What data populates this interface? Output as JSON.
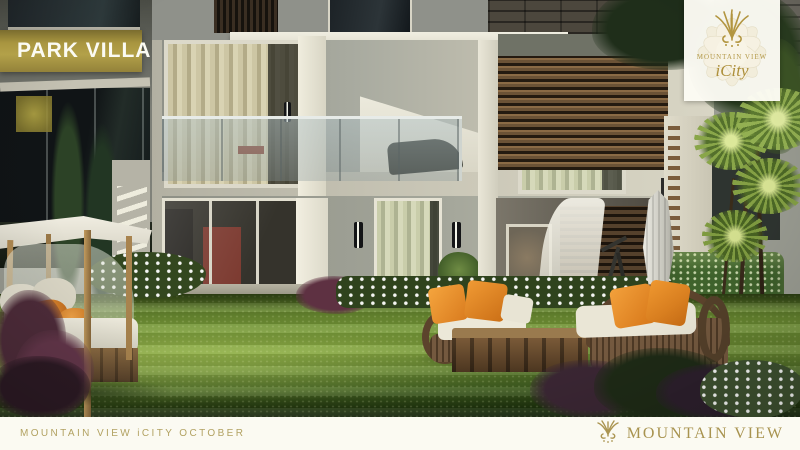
{
  "badge": {
    "label": "PARK VILLA"
  },
  "logo_card": {
    "brand": "MOUNTAIN VIEW",
    "sub_brand": "iCity",
    "icon": "lotus-flower-icon"
  },
  "footer": {
    "project_label": "MOUNTAIN VIEW iCITY OCTOBER",
    "brand": "MOUNTAIN VIEW",
    "icon": "palm-crest-icon"
  },
  "colors": {
    "badge_gold": "#b3a149",
    "logo_gold": "#b49a4a",
    "footer_bg": "#fbfaf2",
    "footer_text_gold": "#b2a262",
    "footer_brand_gold": "#a8934f",
    "lawn_green": "#6f9134",
    "accent_orange": "#ea8c2a"
  }
}
